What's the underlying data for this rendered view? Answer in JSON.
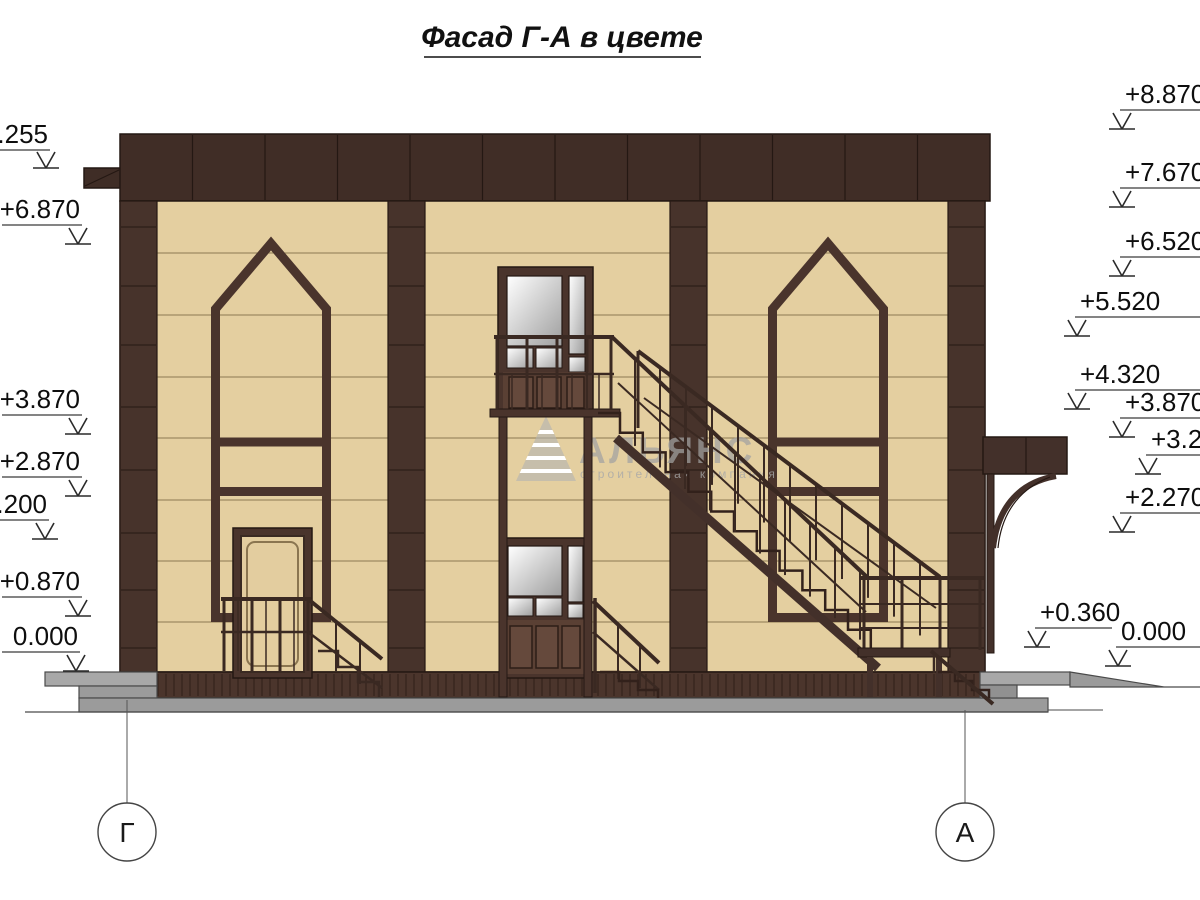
{
  "title": "Фасад Г-А в цвете",
  "watermark": {
    "name": "АЛЬЯНС",
    "subtitle": "строительная компания"
  },
  "axes": {
    "left_label": "Г",
    "right_label": "А"
  },
  "elevation_marks": {
    "left": [
      "+8.255",
      "+6.870",
      "+3.870",
      "+2.870",
      "+2.200",
      "+0.870",
      "0.000"
    ],
    "right": [
      "+8.870",
      "+7.670",
      "+6.520",
      "+5.520",
      "+4.320",
      "+3.870",
      "+3.270",
      "+2.270",
      "+0.360",
      "0.000"
    ]
  },
  "colors": {
    "wall_tan": "#e4cfa0",
    "dark_brown": "#43302a",
    "pilaster_brown": "#47332b",
    "frame_brown": "#4a342c",
    "plinth_brown": "#4b352c",
    "door_wood": "#5a4034",
    "sidewalk_gray": "#9b9b9b",
    "slab_gray": "#a8a8a8",
    "annotation": "#1a1a1a"
  }
}
